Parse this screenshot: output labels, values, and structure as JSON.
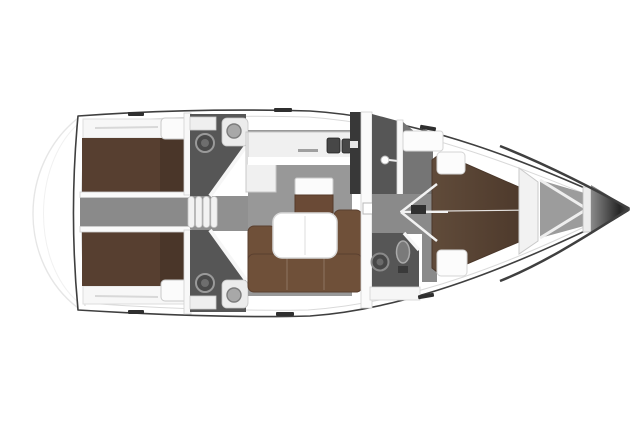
{
  "plan": {
    "kind": "sailing-yacht-interior-floor-plan",
    "orientation": "bow-right-stern-left",
    "rooms": [
      {
        "id": "aft-cabin-port",
        "label": "aft double cabin (top)"
      },
      {
        "id": "aft-cabin-starboard",
        "label": "aft double cabin (bottom)"
      },
      {
        "id": "engine-corridor",
        "label": "engine box / corridor between aft cabins"
      },
      {
        "id": "head-aft-port",
        "label": "aft head with toilet and sink (top)"
      },
      {
        "id": "head-aft-starboard",
        "label": "aft head with toilet and sink (bottom)"
      },
      {
        "id": "companionway-steps",
        "label": "companionway steps"
      },
      {
        "id": "galley",
        "label": "L-shaped galley with double sink"
      },
      {
        "id": "nav-station",
        "label": "chart table with seat"
      },
      {
        "id": "salon",
        "label": "salon with U-sofa and folding table"
      },
      {
        "id": "shower-forward",
        "label": "forward shower compartment"
      },
      {
        "id": "head-forward",
        "label": "forward head with toilet and shower column"
      },
      {
        "id": "forward-cabin",
        "label": "forward V-berth cabin"
      },
      {
        "id": "anchor-locker",
        "label": "bow anchor locker"
      }
    ]
  },
  "colors": {
    "page_bg": "#ffffff",
    "hull_fill": "#ffffff",
    "hull_stroke": "#3f3f3f",
    "deck_line": "#d9d9d9",
    "platform_line": "#e6e6e6",
    "salon_floor": "#989898",
    "corridor_floor": "#8a8a8a",
    "entry_floor": "#909090",
    "vestibule_floor": "#757575",
    "head_floor": "#565656",
    "locker_dark": "#383838",
    "aft_bed": "#573f30",
    "fwd_bed_light": "#604b3a",
    "fwd_bed_dark": "#4e3a2c",
    "sofa": "#6f5039",
    "sofa_stroke": "#5a3f2f",
    "chart_table": "#6a4a36",
    "furniture_white": "#fbfbfb",
    "furniture_stroke": "#c9c9c9",
    "counter_fill": "#f0f0f0",
    "sink_dark": "#474747",
    "fixture_mid": "#7a7a7a",
    "fixture_ring": "#9a9a9a",
    "anchor_floor": "#9c9c9c",
    "bow_cone_start": "#8a8a8a",
    "bow_cone_end": "#262626",
    "mark_dark": "#2f2f2f",
    "wall_white": "#f8f8f8"
  }
}
